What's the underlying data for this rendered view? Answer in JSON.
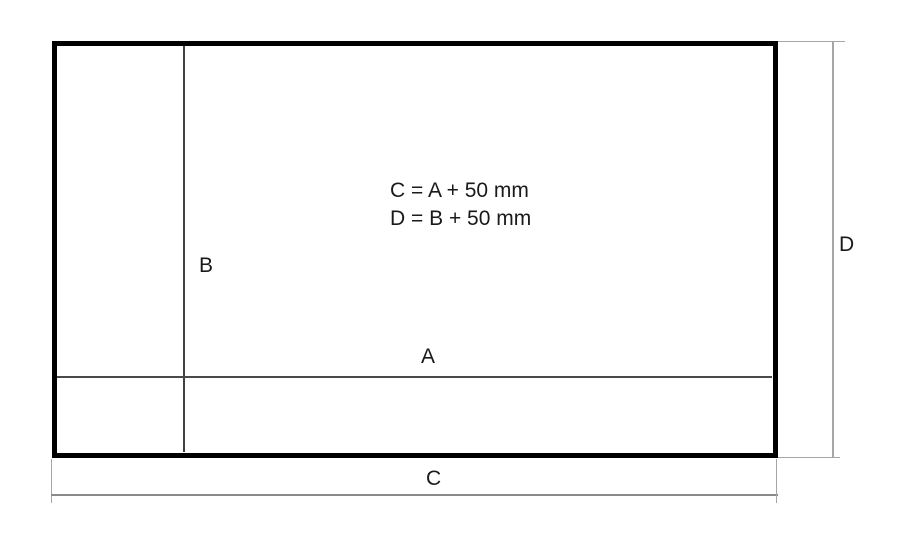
{
  "diagram": {
    "formulas": {
      "line1": "C = A + 50 mm",
      "line2": "D = B + 50 mm"
    },
    "labels": {
      "inner_width": "A",
      "inner_height": "B",
      "outer_width": "C",
      "outer_height": "D"
    },
    "colors": {
      "outline": "#000000",
      "inner_line": "#404040",
      "dimension_line_c": "#8a8a8a",
      "dimension_line_d": "#a6a6a6",
      "text": "#1a1a1a",
      "background": "#ffffff"
    }
  }
}
